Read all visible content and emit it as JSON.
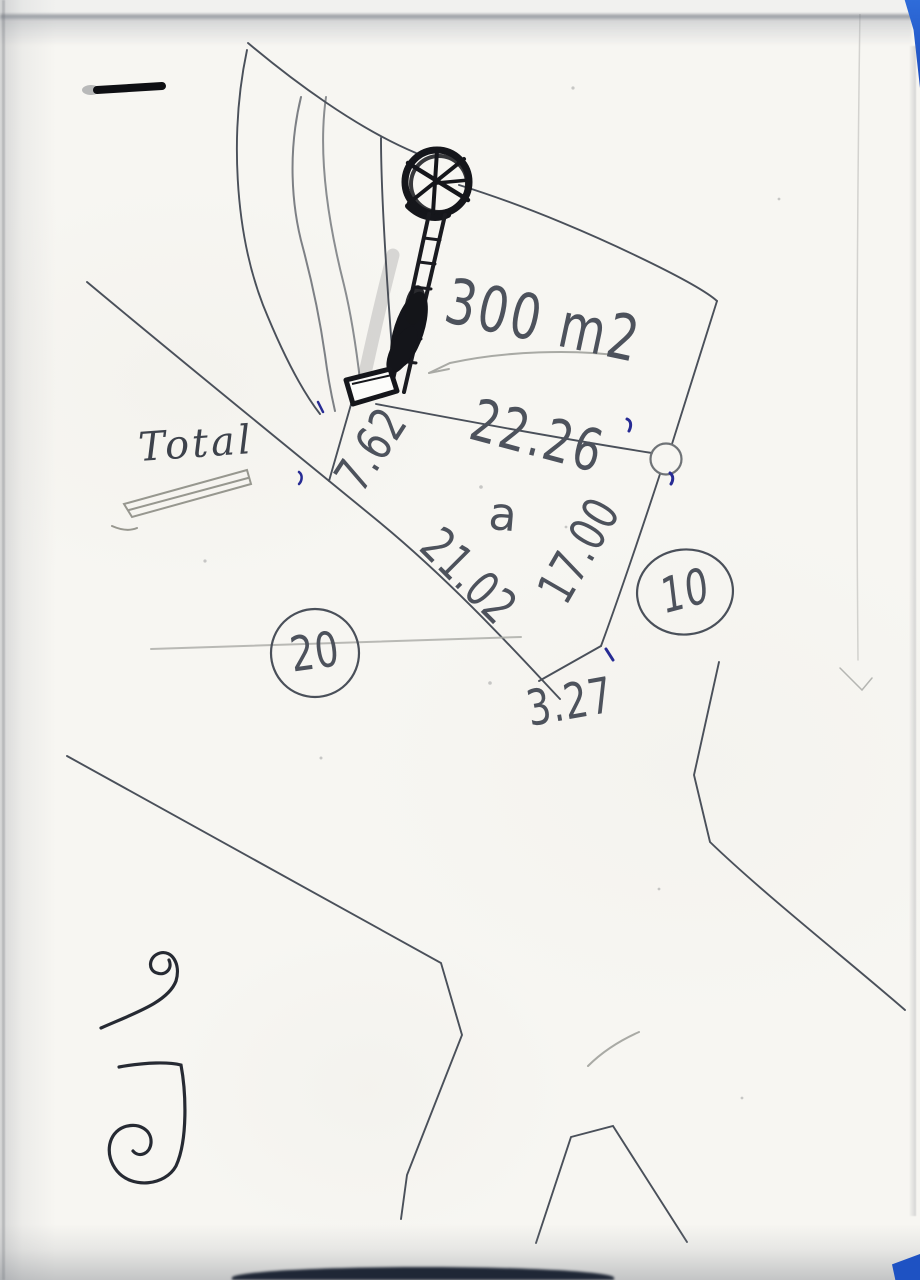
{
  "colors": {
    "paper": "#f7f6f2",
    "ink": "#4d525c",
    "pencil": "#a9aaa5",
    "heavy_ink": "#15161b",
    "blue_ink": "#272b94",
    "edge_blue": "#1e52c3"
  },
  "labels": {
    "total": "Total",
    "area": "300 m2",
    "plot_letter": "a"
  },
  "measurements": {
    "top_edge": "22.26",
    "left_edge": "7.62",
    "diagonal_edge": "21.02",
    "right_edge": "17.00",
    "bottom_edge": "3.27"
  },
  "parcels": {
    "left": "20",
    "right": "10"
  }
}
